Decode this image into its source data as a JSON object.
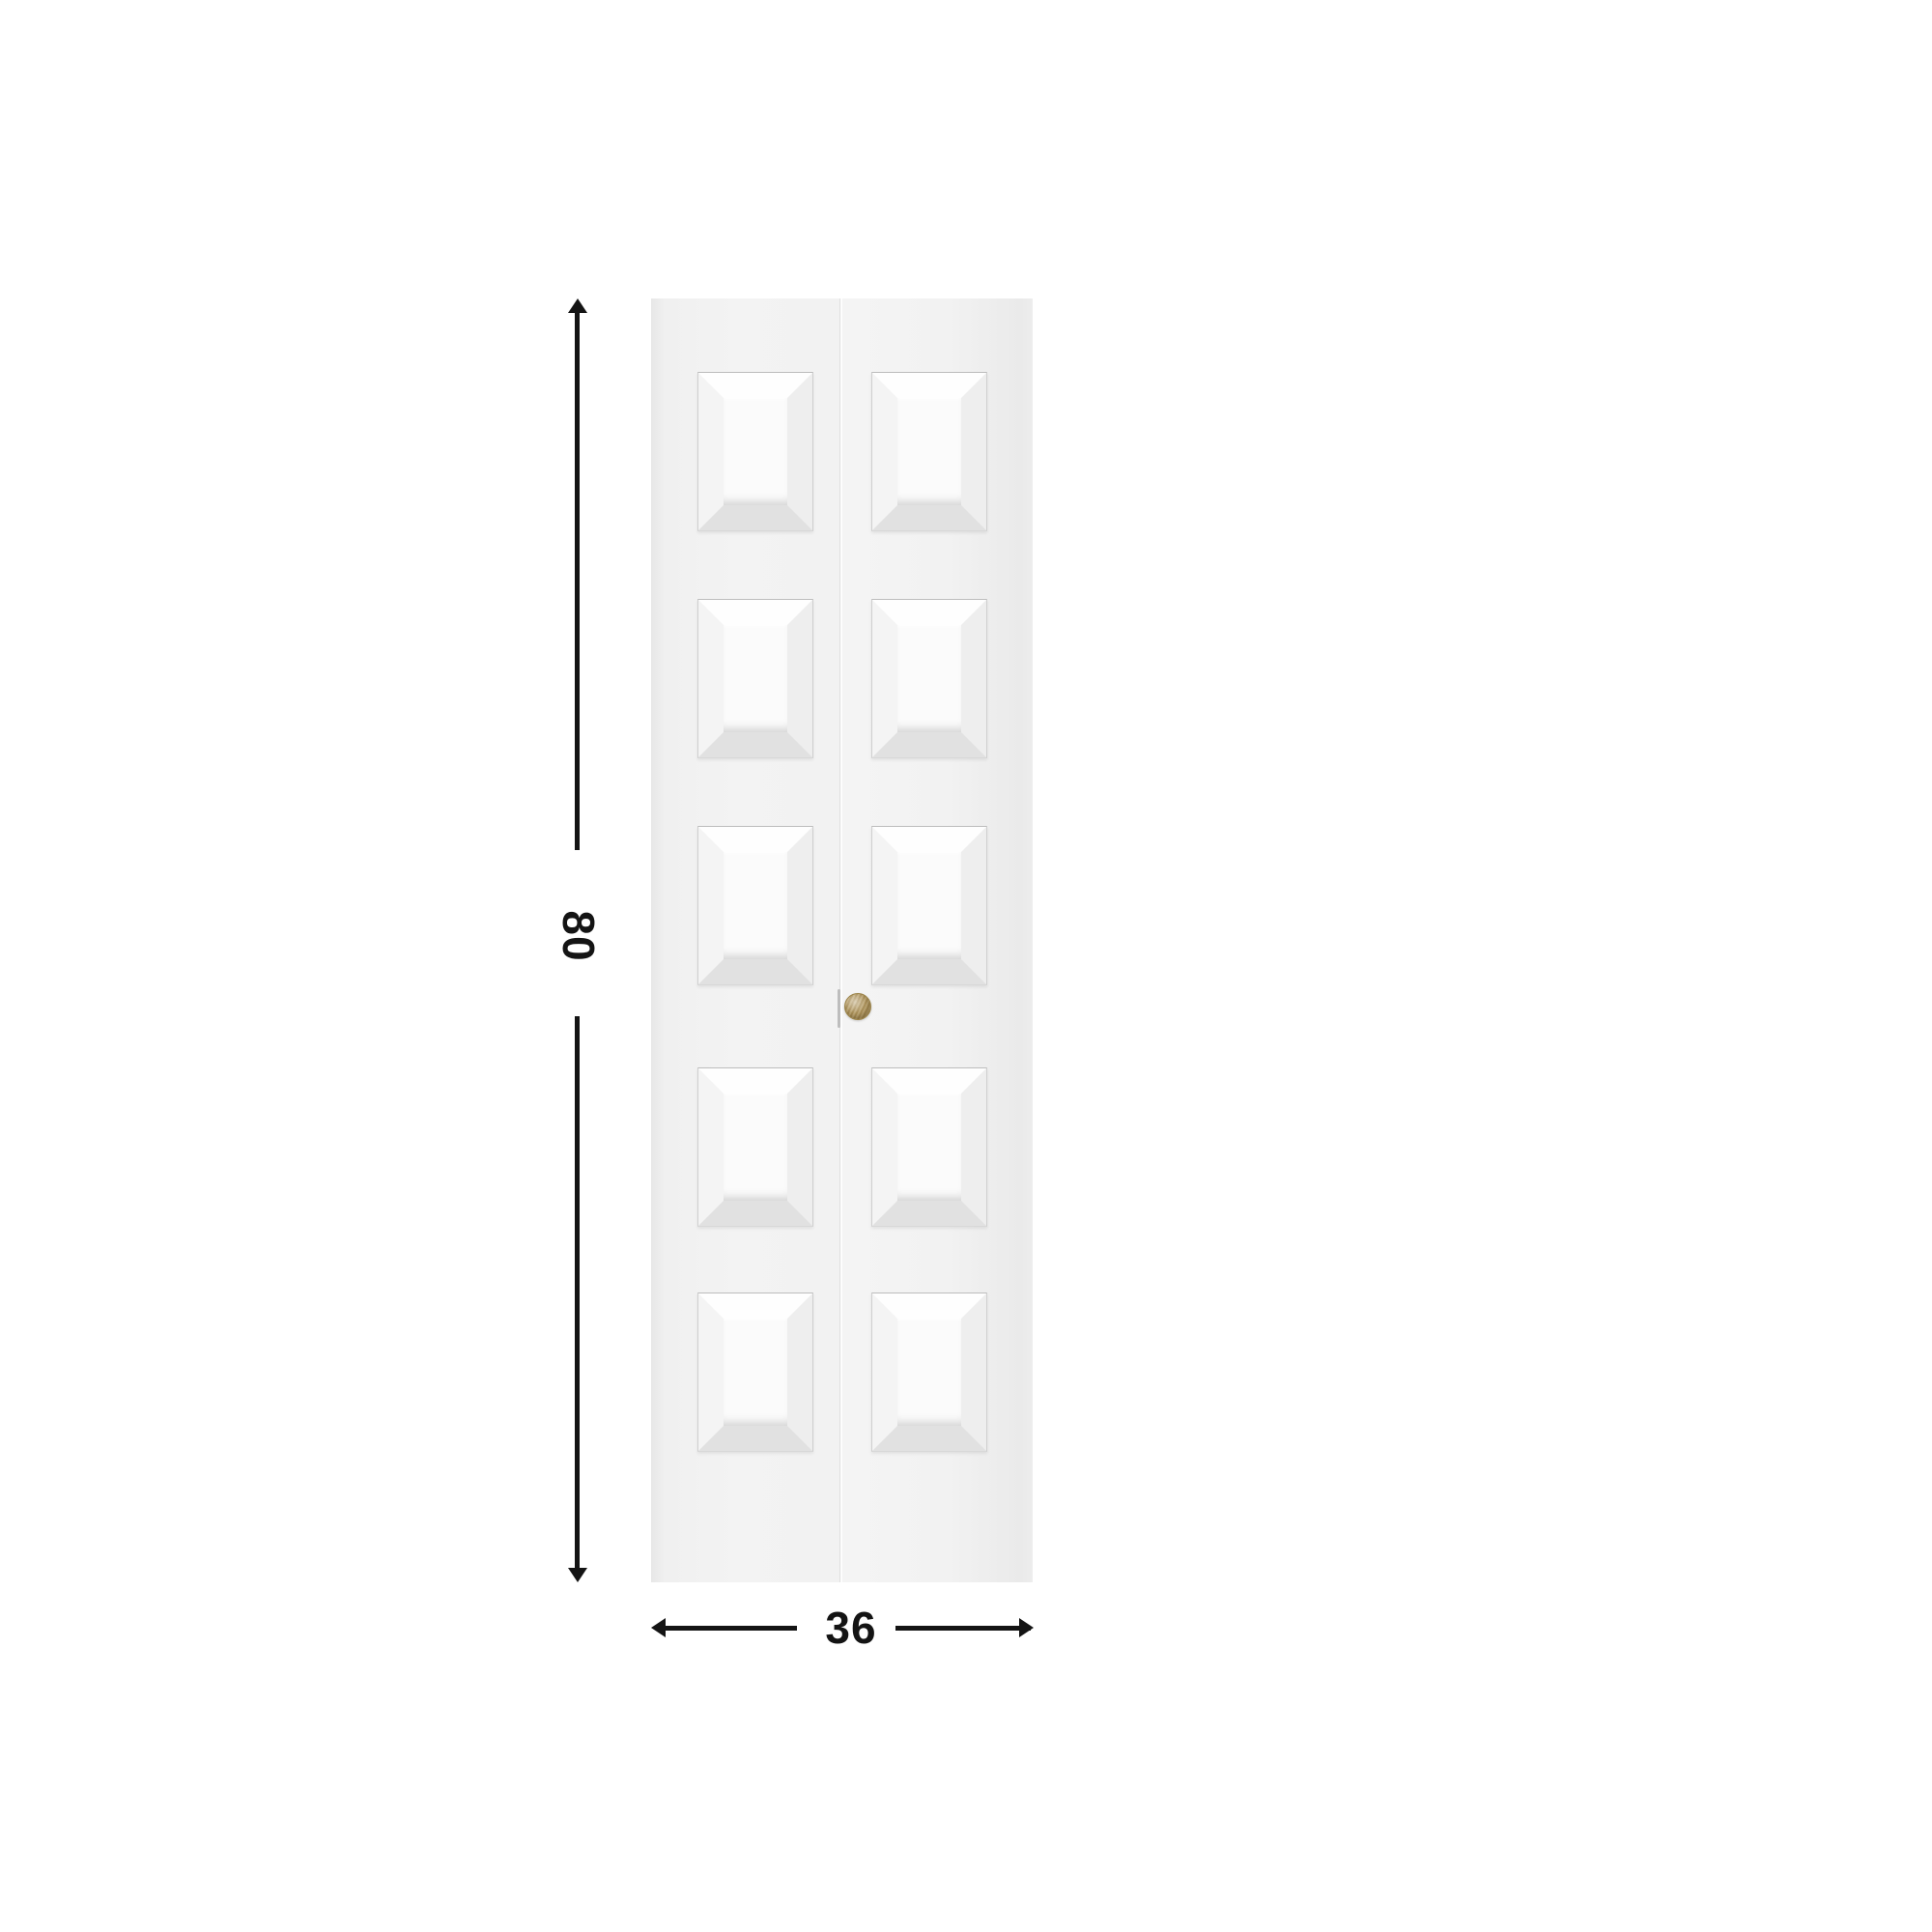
{
  "diagram": {
    "background_color": "#ffffff",
    "line_color": "#141414"
  },
  "door": {
    "leaves": 2,
    "panels_per_leaf": 5,
    "face_color": "#f2f2f2",
    "knob_color": "#b1965c"
  },
  "dimensions": {
    "height_label": "80",
    "width_label": "36"
  }
}
